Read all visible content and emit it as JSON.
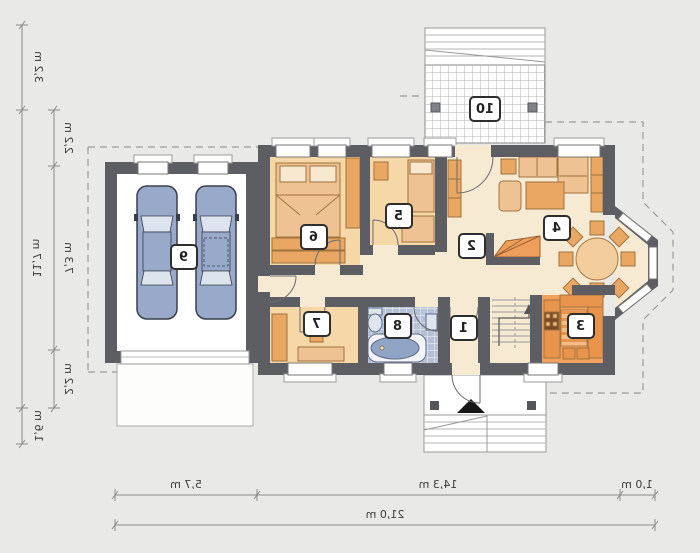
{
  "plan_type": "house-ground-floor-plan-mirrored",
  "rooms": {
    "r1": "1",
    "r2": "2",
    "r3": "3",
    "r4": "4",
    "r5": "5",
    "r6": "6",
    "r7": "7",
    "r8": "8",
    "r9": "9",
    "r10": "10"
  },
  "dims": {
    "left_outer": [
      "3,2 m",
      "11,7 m",
      "1,6 m"
    ],
    "left_inner": [
      "2,2 m",
      "7,3 m",
      "2,2 m"
    ],
    "bottom": [
      "5,7 m",
      "14,3 m",
      "1,0 m"
    ],
    "bottom_total": "21,0 m"
  },
  "colors": {
    "wall": "#5d5e64",
    "bedroom_fill": "#f6d7a8",
    "hall_fill": "#f7ead2",
    "kitchen_fill": "#f2a05e",
    "bath_floor": "#b6c1d5",
    "furniture": "#eec293",
    "furniture_dark": "#e9a763",
    "car": "#98a9c9",
    "background": "#e9eae7"
  }
}
